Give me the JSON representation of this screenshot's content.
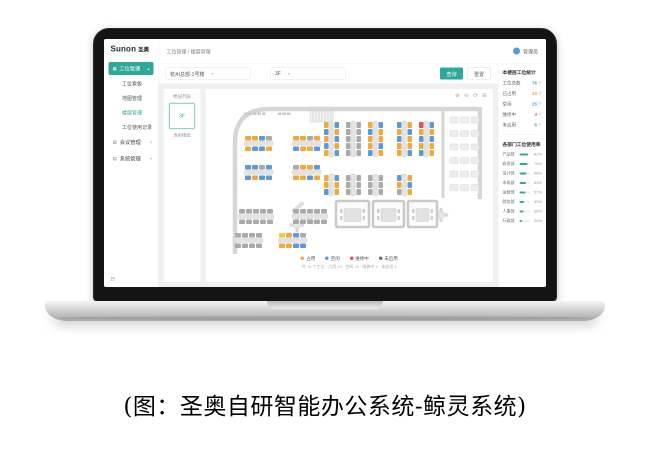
{
  "caption": "(图：圣奥自研智能办公系统-鲸灵系统)",
  "colors": {
    "accent": "#2ea899",
    "occupied": "#f2a93b",
    "free": "#5b9bd5",
    "repair": "#e0524d",
    "disabled": "#aaaaaa"
  },
  "app": {
    "logo": {
      "brand": "Sunon",
      "brand_cn": "圣奥"
    },
    "sidebar": {
      "active_parent": {
        "label": "工位管理"
      },
      "sub_items": [
        {
          "label": "工位看板",
          "active": false
        },
        {
          "label": "地图管理",
          "active": false
        },
        {
          "label": "楼层管理",
          "active": true
        },
        {
          "label": "工位使用记录",
          "active": false
        }
      ],
      "parents": [
        {
          "label": "会议管理"
        },
        {
          "label": "系统管理"
        }
      ]
    },
    "topbar": {
      "breadcrumb": "工位管理 / 楼层管理",
      "user": "管理员"
    },
    "filterbar": {
      "building_select": "杭州总部·1号楼",
      "floor_select": "3F",
      "search_label": "查询",
      "reset_label": "重置"
    },
    "floorlist": {
      "title": "楼层列表",
      "selected": "3F",
      "selected_caption": "当前楼层"
    },
    "canvas": {
      "tools": [
        "zoom-in",
        "zoom-out",
        "refresh",
        "fullscreen"
      ],
      "legend": [
        {
          "label": "占用",
          "color": "#f2a93b"
        },
        {
          "label": "空闲",
          "color": "#5b9bd5"
        },
        {
          "label": "维修中",
          "color": "#e0524d"
        },
        {
          "label": "未启用",
          "color": "#666b74"
        }
      ],
      "note": "共 76 个工位 · 占用 43 · 空闲 25 · 维修中 3 · 未启用 5"
    },
    "stats": {
      "title": "本楼层工位统计",
      "rows": [
        {
          "label": "工位总数",
          "value": "76",
          "unit": "个",
          "color": "#2ea899"
        },
        {
          "label": "已占用",
          "value": "43",
          "unit": "个",
          "color": "#f2a93b"
        },
        {
          "label": "空闲",
          "value": "25",
          "unit": "个",
          "color": "#5b9bd5"
        },
        {
          "label": "维修中",
          "value": "3",
          "unit": "个",
          "color": "#e0524d"
        },
        {
          "label": "未启用",
          "value": "5",
          "unit": "个",
          "color": "#2ea899"
        }
      ],
      "usage_title": "各部门工位使用率",
      "usage_rows": [
        {
          "label": "产品部",
          "pct": 82
        },
        {
          "label": "研发部",
          "pct": 76
        },
        {
          "label": "设计部",
          "pct": 68
        },
        {
          "label": "市场部",
          "pct": 63
        },
        {
          "label": "运营部",
          "pct": 57
        },
        {
          "label": "财务部",
          "pct": 45
        },
        {
          "label": "人事部",
          "pct": 38
        },
        {
          "label": "行政部",
          "pct": 26
        }
      ]
    },
    "floorplan": {
      "seat_colors": {
        "o": "#f2a93b",
        "b": "#5b9bd5",
        "g": "#aaaaaa",
        "r": "#e0524d",
        "y": "#f0c94b"
      },
      "h_clusters": [
        {
          "x": 56,
          "y": 84,
          "rows": [
            [
              "o",
              "o",
              "b",
              "g"
            ],
            [
              "o",
              "b",
              "b",
              "o"
            ]
          ]
        },
        {
          "x": 152,
          "y": 84,
          "rows": [
            [
              "o",
              "o",
              "g",
              "o"
            ],
            [
              "b",
              "o",
              "o",
              "b"
            ]
          ]
        },
        {
          "x": 56,
          "y": 142,
          "rows": [
            [
              "b",
              "b",
              "g",
              "b"
            ],
            [
              "b",
              "o",
              "b",
              "b"
            ]
          ]
        },
        {
          "x": 152,
          "y": 142,
          "rows": [
            [
              "g",
              "o",
              "o",
              "b"
            ],
            [
              "o",
              "o",
              "b",
              "o"
            ]
          ]
        },
        {
          "x": 44,
          "y": 230,
          "rows": [
            [
              "g",
              "g",
              "g",
              "g",
              "g"
            ],
            [
              "g",
              "g",
              "g",
              "g",
              "g"
            ]
          ]
        },
        {
          "x": 152,
          "y": 230,
          "rows": [
            [
              "g",
              "g",
              "g",
              "g",
              "g"
            ],
            [
              "g",
              "g",
              "g",
              "g",
              "g"
            ]
          ]
        },
        {
          "x": 36,
          "y": 278,
          "rows": [
            [
              "g",
              "g",
              "g",
              "g"
            ],
            [
              "g",
              "g",
              "g",
              "g"
            ]
          ]
        },
        {
          "x": 124,
          "y": 278,
          "rows": [
            [
              "y",
              "o",
              "b",
              "g"
            ],
            [
              "o",
              "o",
              "b",
              "b"
            ]
          ]
        }
      ],
      "v_clusters": [
        {
          "x": 214,
          "y": 56,
          "cols": [
            [
              "o",
              "b",
              "o",
              "b",
              "o"
            ],
            [
              "b",
              "o",
              "b",
              "o",
              "b"
            ]
          ]
        },
        {
          "x": 258,
          "y": 56,
          "cols": [
            [
              "g",
              "g",
              "g",
              "g",
              "g"
            ],
            [
              "g",
              "g",
              "g",
              "g",
              "g"
            ]
          ]
        },
        {
          "x": 302,
          "y": 56,
          "cols": [
            [
              "o",
              "b",
              "o",
              "o",
              "b"
            ],
            [
              "b",
              "o",
              "o",
              "b",
              "o"
            ]
          ]
        },
        {
          "x": 360,
          "y": 56,
          "cols": [
            [
              "b",
              "o",
              "b",
              "o",
              "o"
            ],
            [
              "o",
              "b",
              "o",
              "o",
              "b"
            ]
          ]
        },
        {
          "x": 404,
          "y": 56,
          "cols": [
            [
              "r",
              "o",
              "b",
              "o",
              "b"
            ],
            [
              "b",
              "o",
              "b",
              "o",
              "o"
            ]
          ]
        },
        {
          "x": 214,
          "y": 162,
          "cols": [
            [
              "o",
              "o",
              "b"
            ],
            [
              "b",
              "o",
              "o"
            ]
          ]
        },
        {
          "x": 258,
          "y": 162,
          "cols": [
            [
              "g",
              "g",
              "g"
            ],
            [
              "g",
              "g",
              "g"
            ]
          ]
        },
        {
          "x": 302,
          "y": 162,
          "cols": [
            [
              "g",
              "g",
              "g"
            ],
            [
              "g",
              "g",
              "g"
            ]
          ]
        },
        {
          "x": 360,
          "y": 162,
          "cols": [
            [
              "b",
              "o",
              "g"
            ],
            [
              "o",
              "b",
              "o"
            ]
          ]
        }
      ],
      "rooms": [
        {
          "x": 238,
          "y": 214,
          "w": 66,
          "h": 52
        },
        {
          "x": 312,
          "y": 214,
          "w": 62,
          "h": 52
        },
        {
          "x": 382,
          "y": 214,
          "w": 58,
          "h": 52
        }
      ]
    }
  }
}
